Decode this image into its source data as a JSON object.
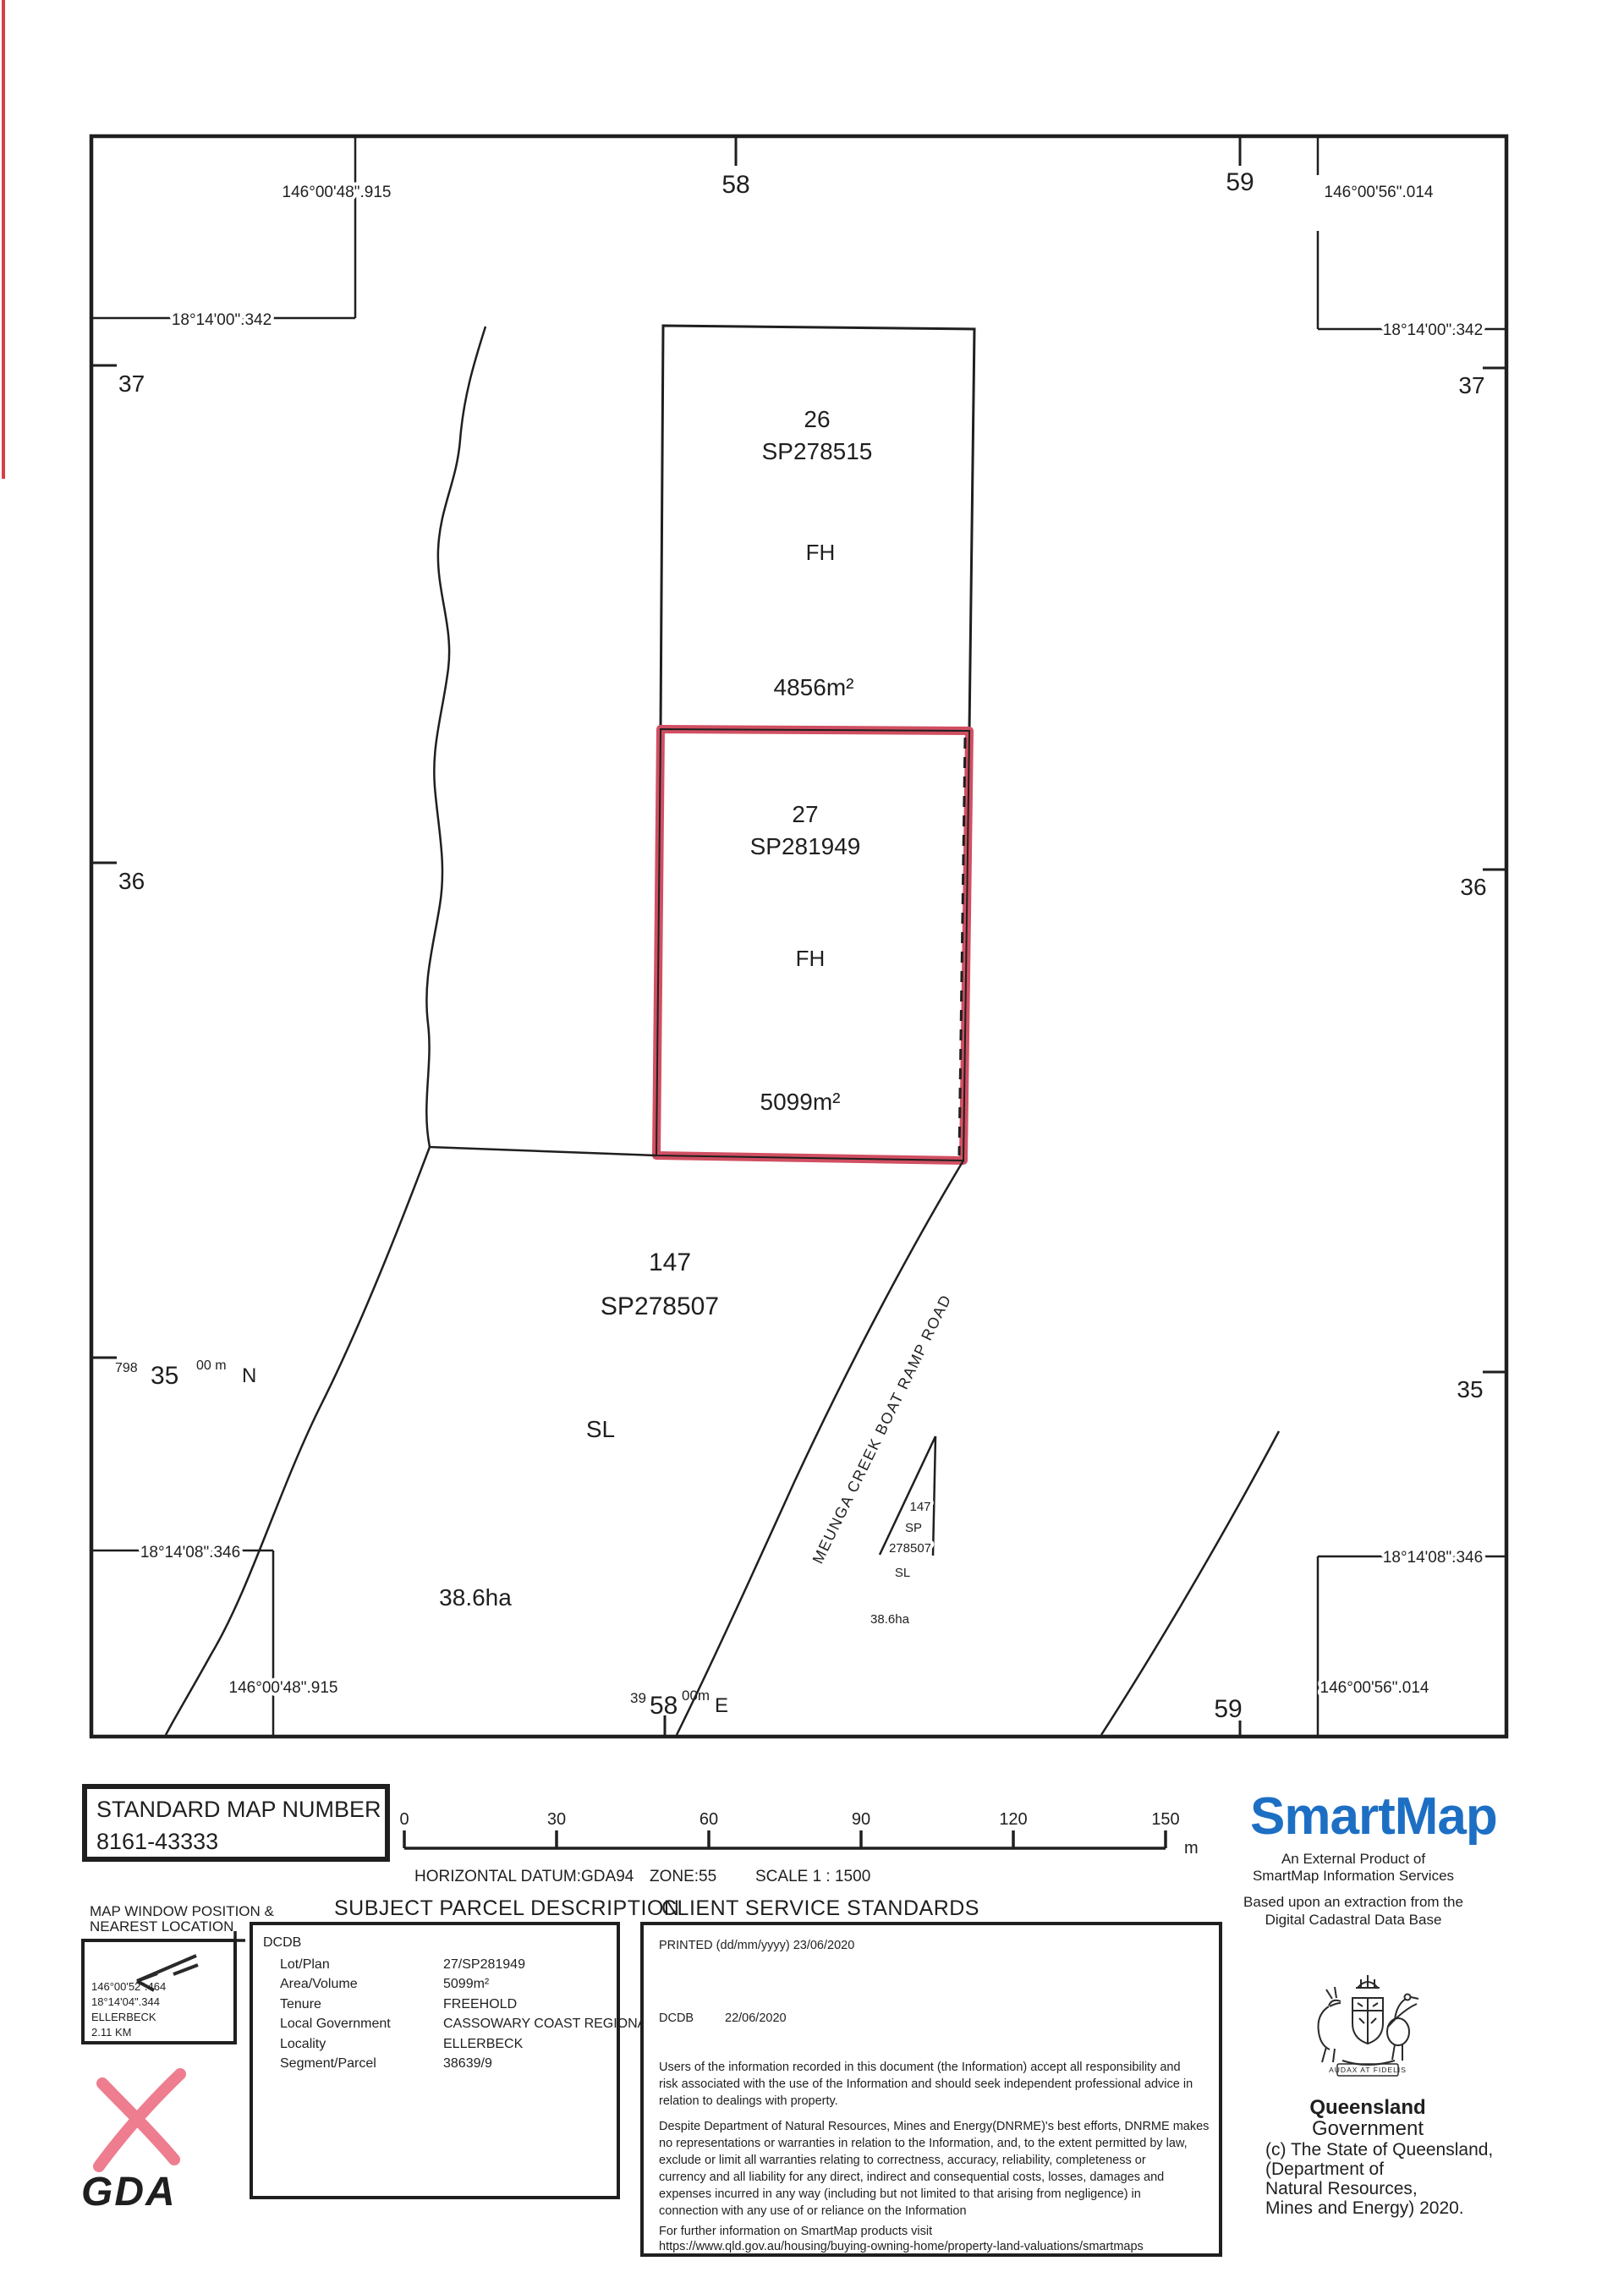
{
  "map": {
    "corner_refs": {
      "top_left_lon": "146°00'48\".915",
      "top_left_lat": "18°14'00\".342",
      "top_right_lon": "146°00'56\".014",
      "top_right_lat": "18°14'00\".342",
      "bottom_left_lat": "18°14'08\".346",
      "bottom_left_lon": "146°00'48\".915",
      "bottom_right_lat": "18°14'08\".346",
      "bottom_right_lon": "146°00'56\".014"
    },
    "grid": {
      "top_ticks": [
        "58",
        "59"
      ],
      "bottom_tick": "59",
      "left_ticks": [
        "37",
        "36"
      ],
      "right_ticks": [
        "37",
        "36",
        "35"
      ],
      "northing": {
        "prefix": "798",
        "main": "35",
        "sup": "00 m",
        "dir": "N"
      },
      "easting": {
        "prefix": "39",
        "main": "58",
        "sup": "00m",
        "dir": "E"
      }
    },
    "parcels": {
      "lot26": {
        "lot": "26",
        "plan": "SP278515",
        "tenure": "FH",
        "area": "4856m²"
      },
      "lot27": {
        "lot": "27",
        "plan": "SP281949",
        "tenure": "FH",
        "area": "5099m²",
        "highlight_color": "#d14f62"
      },
      "lot147": {
        "lot": "147",
        "plan": "SP278507",
        "tenure": "SL",
        "area": "38.6ha"
      },
      "lot147_small": {
        "lot": "147",
        "plan_line1": "SP",
        "plan_line2": "278507",
        "tenure": "SL",
        "area": "38.6ha"
      }
    },
    "road_label": "MEUNGA CREEK BOAT RAMP ROAD"
  },
  "panel": {
    "standard_map": {
      "title": "STANDARD MAP NUMBER",
      "number": "8161-43333"
    },
    "scalebar": {
      "ticks": [
        "0",
        "30",
        "60",
        "90",
        "120",
        "150"
      ],
      "unit": "m",
      "datum": "HORIZONTAL DATUM:GDA94",
      "zone": "ZONE:55",
      "scale": "SCALE 1 : 1500"
    },
    "map_window": {
      "title_line1": "MAP WINDOW POSITION &",
      "title_line2": "NEAREST LOCATION",
      "lon": "146°00'52\".464",
      "lat": "18°14'04\".344",
      "locality": "ELLERBECK",
      "distance": "2.11 KM"
    },
    "gda_label": "GDA",
    "subject_parcel": {
      "heading": "SUBJECT PARCEL DESCRIPTION",
      "source": "DCDB",
      "rows": [
        {
          "label": "Lot/Plan",
          "value": "27/SP281949"
        },
        {
          "label": "Area/Volume",
          "value": "5099m²"
        },
        {
          "label": "Tenure",
          "value": "FREEHOLD"
        },
        {
          "label": "Local Government",
          "value": "CASSOWARY COAST REGIONAL"
        },
        {
          "label": "Locality",
          "value": "ELLERBECK"
        },
        {
          "label": "Segment/Parcel",
          "value": "38639/9"
        }
      ]
    },
    "client_service": {
      "heading": "CLIENT SERVICE STANDARDS",
      "printed": "PRINTED (dd/mm/yyyy) 23/06/2020",
      "dcdb_label": "DCDB",
      "dcdb_date": "22/06/2020",
      "para1": [
        "Users of the information recorded in this document (the Information) accept all responsibility and",
        "risk associated with the use of the Information and should seek independent professional advice in",
        "relation to dealings with property."
      ],
      "para2": [
        "Despite Department of Natural Resources, Mines and Energy(DNRME)'s best efforts, DNRME makes",
        "no representations or warranties in relation to the Information, and, to the extent permitted by law,",
        "exclude or limit all warranties relating to correctness, accuracy, reliability, completeness or",
        "currency and all liability for any direct, indirect and consequential costs, losses, damages and",
        "expenses incurred in any way (including but not limited to that arising from negligence) in",
        "connection with any use of or reliance on the Information"
      ],
      "further": "For further information on SmartMap products visit",
      "url": "https://www.qld.gov.au/housing/buying-owning-home/property-land-valuations/smartmaps"
    }
  },
  "branding": {
    "smartmap": {
      "logo": "SmartMap",
      "color": "#1d6fc4",
      "line1": "An External Product of",
      "line2": "SmartMap Information Services",
      "line3": "Based upon an extraction from the",
      "line4": "Digital Cadastral Data Base"
    },
    "qld": {
      "name": "Queensland",
      "gov": "Government",
      "motto": "AUDAX AT FIDELIS",
      "copy1": "(c) The State of Queensland,",
      "copy2": "(Department of",
      "copy3": "Natural Resources,",
      "copy4": "Mines and Energy) 2020."
    }
  }
}
